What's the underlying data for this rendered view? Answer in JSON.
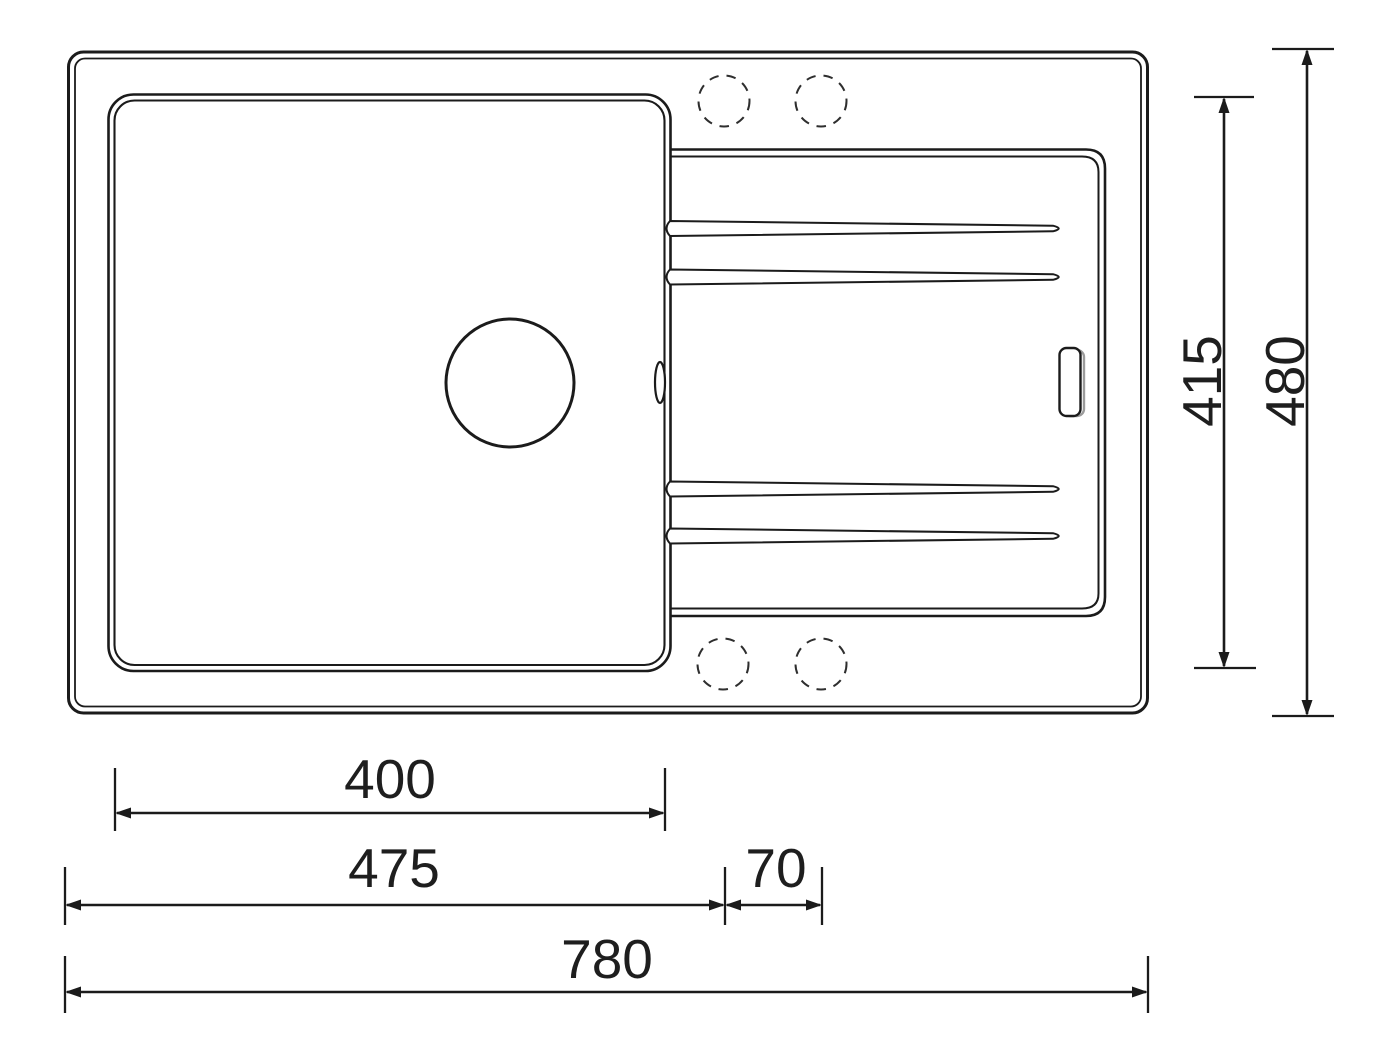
{
  "drawing": {
    "kind": "sink-top-view-dimension-drawing"
  },
  "dimensions": {
    "bowl_width": "400",
    "left_section_width": "475",
    "edge_strip_width": "70",
    "overall_width": "780",
    "inner_depth": "415",
    "overall_depth": "480"
  },
  "colors": {
    "line": "#1b1b1b",
    "dashed_line": "#2e2e2e",
    "shadow": "#9b9b9b",
    "text": "#1e1e1e",
    "background": "#ffffff"
  }
}
